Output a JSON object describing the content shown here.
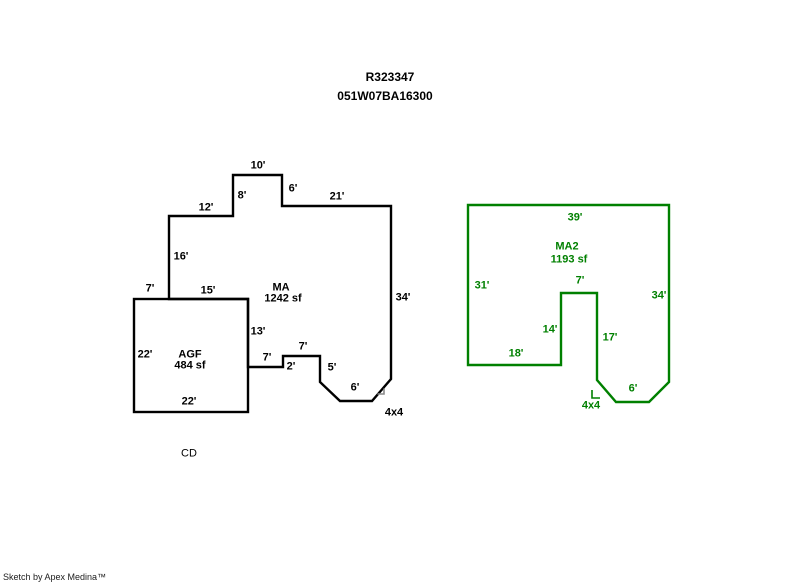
{
  "header": {
    "record_id": "R323347",
    "parcel_id": "051W07BA16300"
  },
  "footer": {
    "credit": "Sketch by Apex Medina™"
  },
  "colors": {
    "background": "#ffffff",
    "primary_outline": "#000000",
    "secondary_outline": "#008000",
    "corner_mark": "#8a8a8a"
  },
  "main_sketch": {
    "labels": {
      "area_name": "MA",
      "area_sf": "1242 sf",
      "sub_area_name": "AGF",
      "sub_area_sf": "484 sf",
      "comment": "CD"
    },
    "dimensions": [
      {
        "text": "10'",
        "x": 258,
        "y": 166
      },
      {
        "text": "8'",
        "x": 242,
        "y": 196
      },
      {
        "text": "6'",
        "x": 293,
        "y": 189
      },
      {
        "text": "12'",
        "x": 206,
        "y": 208
      },
      {
        "text": "21'",
        "x": 337,
        "y": 197
      },
      {
        "text": "16'",
        "x": 181,
        "y": 257
      },
      {
        "text": "34'",
        "x": 403,
        "y": 298
      },
      {
        "text": "7'",
        "x": 150,
        "y": 289
      },
      {
        "text": "15'",
        "x": 208,
        "y": 291
      },
      {
        "text": "13'",
        "x": 258,
        "y": 332
      },
      {
        "text": "22'",
        "x": 145,
        "y": 355
      },
      {
        "text": "7'",
        "x": 267,
        "y": 358
      },
      {
        "text": "2'",
        "x": 291,
        "y": 367
      },
      {
        "text": "7'",
        "x": 303,
        "y": 347
      },
      {
        "text": "5'",
        "x": 332,
        "y": 368
      },
      {
        "text": "6'",
        "x": 355,
        "y": 388
      },
      {
        "text": "22'",
        "x": 189,
        "y": 402
      },
      {
        "text": "4x4",
        "x": 394,
        "y": 413
      }
    ]
  },
  "secondary_sketch": {
    "labels": {
      "area_name": "MA2",
      "area_sf": "1193 sf"
    },
    "dimensions": [
      {
        "text": "39'",
        "x": 575,
        "y": 218
      },
      {
        "text": "31'",
        "x": 482,
        "y": 286
      },
      {
        "text": "34'",
        "x": 659,
        "y": 296
      },
      {
        "text": "7'",
        "x": 580,
        "y": 281
      },
      {
        "text": "14'",
        "x": 550,
        "y": 330
      },
      {
        "text": "17'",
        "x": 610,
        "y": 338
      },
      {
        "text": "18'",
        "x": 516,
        "y": 354
      },
      {
        "text": "6'",
        "x": 633,
        "y": 389
      },
      {
        "text": "4x4",
        "x": 591,
        "y": 406
      }
    ]
  }
}
